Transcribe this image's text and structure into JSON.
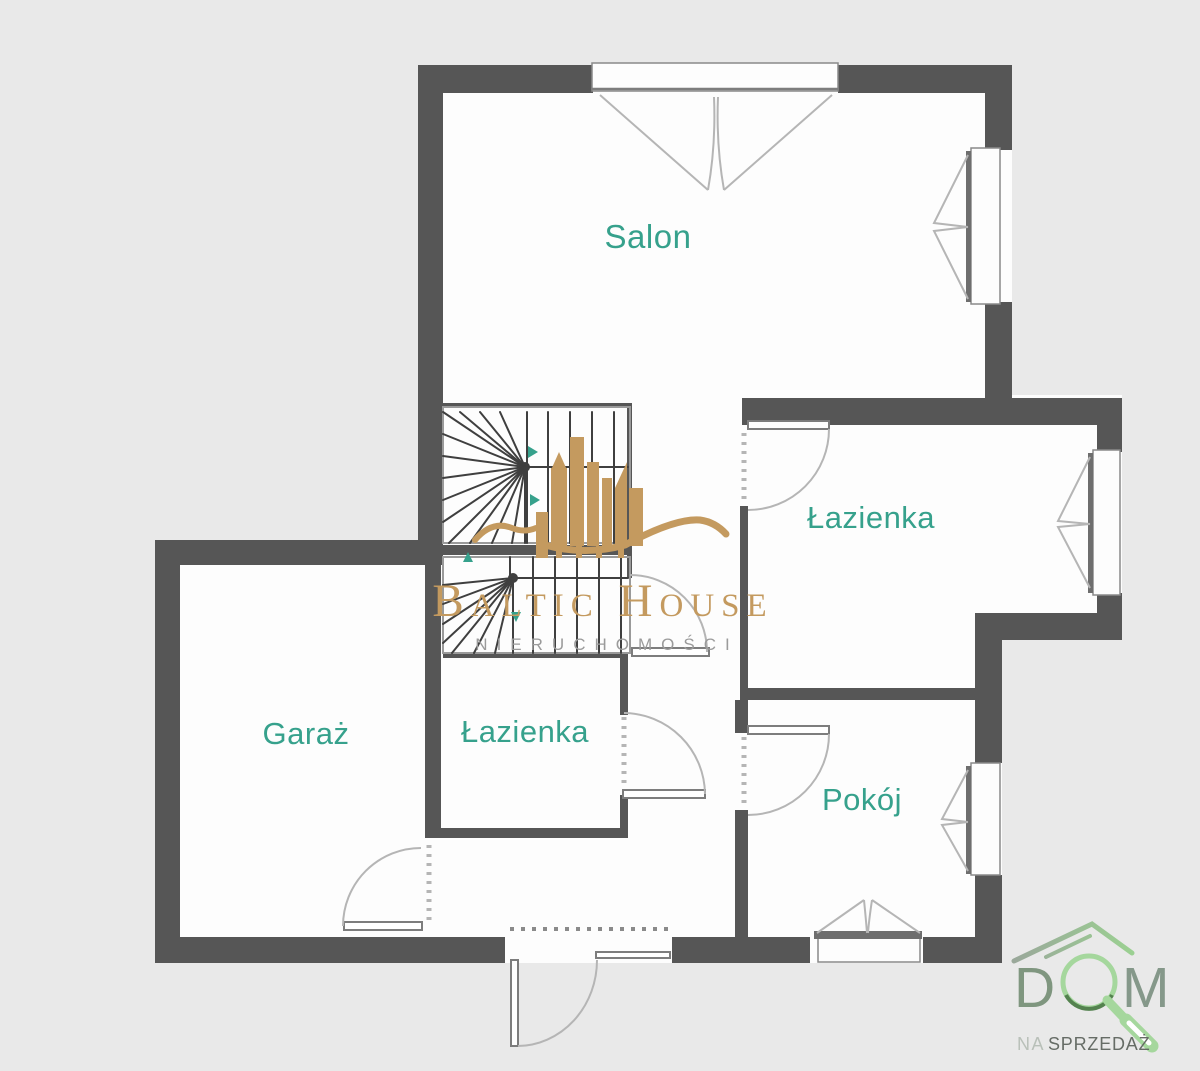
{
  "colors": {
    "background": "#e9e9e9",
    "room_fill": "#fdfdfd",
    "wall": "#565656",
    "label_teal": "#36a18c",
    "line_gray": "#b5b5b5",
    "frame_gray": "#6e6e6e",
    "stair_line": "#3f3f3f",
    "stair_border": "#9a9a9a",
    "gold": "#c49a5f",
    "watermark_gray": "#9b9b9b",
    "logo_green_light": "#a5d79d",
    "logo_green_dark": "#54824f",
    "logo_gray_green": "#7f967f",
    "logo_m_green": "#85988a",
    "roof_gray": "#9aa89a",
    "roof_green": "#9bd092",
    "na_gray": "#b9c0b9",
    "sprzedaz_gray": "#666c66"
  },
  "floorplan": {
    "rooms": [
      {
        "id": "salon",
        "label": "Salon"
      },
      {
        "id": "lazienka-right",
        "label": "Łazienka"
      },
      {
        "id": "lazienka-left",
        "label": "Łazienka"
      },
      {
        "id": "garaz",
        "label": "Garaż"
      },
      {
        "id": "pokoj",
        "label": "Pokój"
      }
    ]
  },
  "watermark": {
    "brand": "Baltic House",
    "subtitle": "NIERUCHOMOŚCI"
  },
  "agency_logo": {
    "letter_d": "D",
    "letter_m": "M",
    "line2_prefix": "NA",
    "line2_word": "SPRZEDAŻ"
  }
}
